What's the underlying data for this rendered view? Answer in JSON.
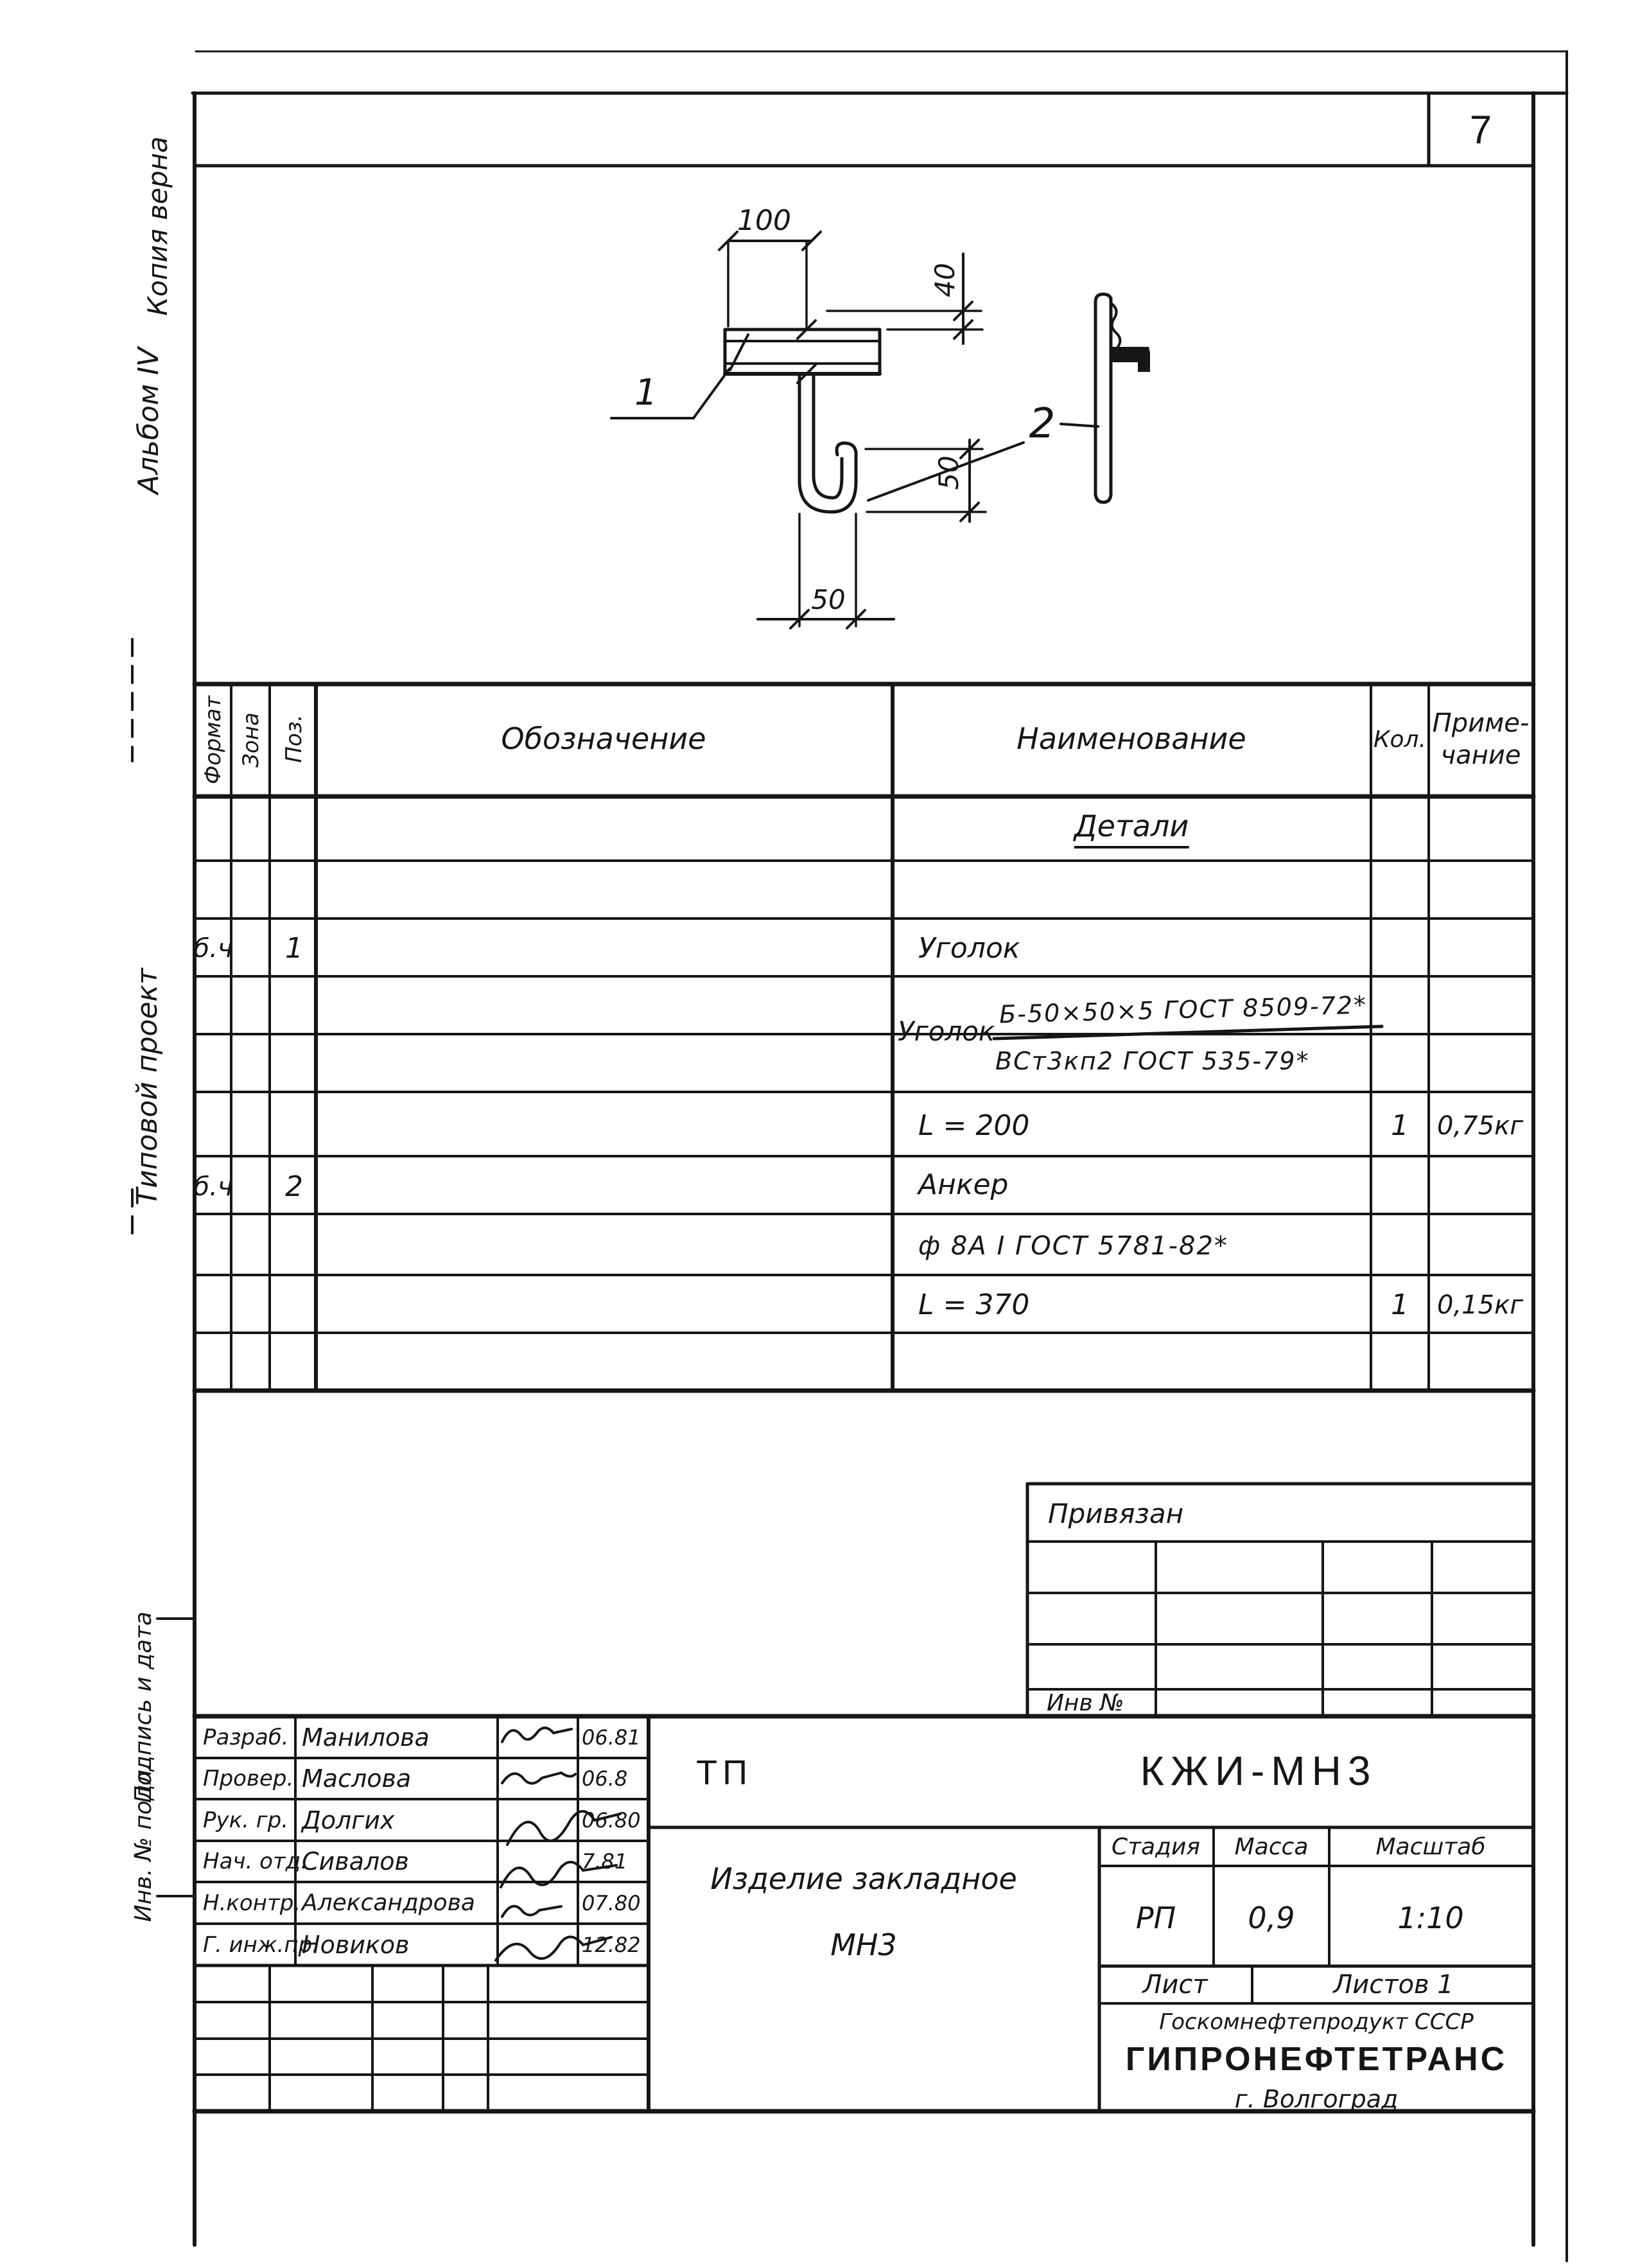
{
  "page": {
    "number": "7"
  },
  "margin": {
    "copy_note": "Копия верна",
    "album": "Альбом IV",
    "project": "Типовой проект",
    "sign_date": "Подпись и дата",
    "inv": "Инв. № подл."
  },
  "drawing": {
    "dims": {
      "top": "100",
      "right": "40",
      "middle": "50",
      "bottom": "50"
    },
    "labels": {
      "part1": "1",
      "part2": "2"
    }
  },
  "spec": {
    "headers": {
      "format": "Формат",
      "zone": "Зона",
      "pos": "Поз.",
      "designation": "Обозначение",
      "name": "Наименование",
      "qty": "Кол.",
      "note1": "Приме-",
      "note2": "чание"
    },
    "section_title": "Детали",
    "rows": [
      {
        "format": "б.ч",
        "pos": "1",
        "name": "Уголок"
      },
      {
        "frac_label": "Уголок",
        "frac_num": "Б-50×50×5 ГОСТ 8509-72*",
        "frac_den": "ВСт3кп2 ГОСТ 535-79*"
      },
      {
        "name": "L = 200",
        "qty": "1",
        "note": "0,75кг"
      },
      {
        "format": "б.ч",
        "pos": "2",
        "name": "Анкер"
      },
      {
        "name": "ф 8А I ГОСТ 5781-82*"
      },
      {
        "name": "L = 370",
        "qty": "1",
        "note": "0,15кг"
      }
    ]
  },
  "binding_table": {
    "title": "Привязан",
    "inv_label": "Инв №"
  },
  "title_block": {
    "code": "ТП",
    "doc_number": "КЖИ-МН3",
    "product_line1": "Изделие закладное",
    "product_line2": "МН3",
    "stage_label": "Стадия",
    "mass_label": "Масса",
    "scale_label": "Масштаб",
    "stage": "РП",
    "mass": "0,9",
    "scale": "1:10",
    "sheet_label": "Лист",
    "sheets_label": "Листов 1",
    "org_line1": "Госкомнефтепродукт СССР",
    "org_line2": "ГИПРОНЕФТЕТРАНС",
    "org_line3": "г. Волгоград",
    "signatures": [
      {
        "role": "Разраб.",
        "name": "Манилова",
        "date": "06.81"
      },
      {
        "role": "Провер.",
        "name": "Маслова",
        "date": "06.8"
      },
      {
        "role": "Рук. гр.",
        "name": "Долгих",
        "date": "06.80"
      },
      {
        "role": "Нач. отд.",
        "name": "Сивалов",
        "date": "7.81"
      },
      {
        "role": "Н.контр.",
        "name": "Александрова",
        "date": "07.80"
      },
      {
        "role": "Г. инж.пр.",
        "name": "Новиков",
        "date": "12.82"
      }
    ]
  }
}
